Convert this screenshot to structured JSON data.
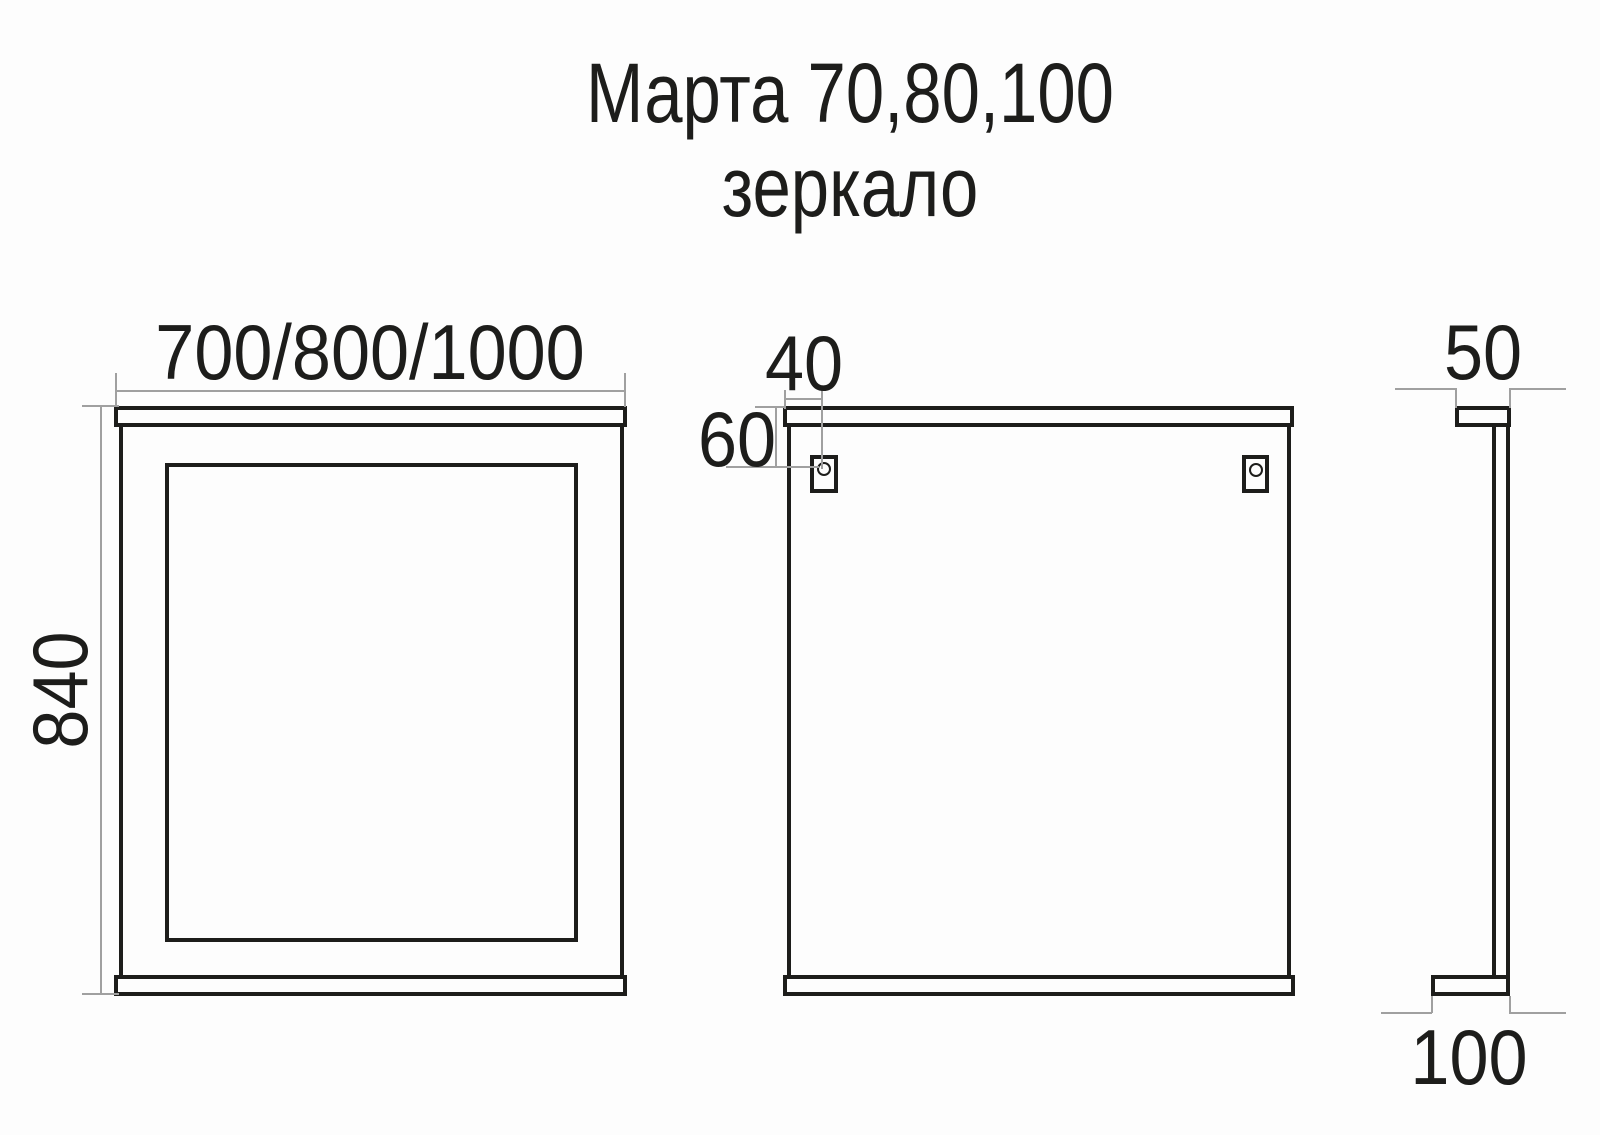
{
  "title": {
    "line1": "Марта 70,80,100",
    "line2": "зеркало"
  },
  "views": {
    "front": {
      "label_width": "700/800/1000",
      "label_height": "840"
    },
    "back": {
      "label_bracket_offset_x": "40",
      "label_bracket_offset_y": "60"
    },
    "side": {
      "label_top_shelf_depth": "50",
      "label_bottom_shelf_depth": "100"
    }
  },
  "colors": {
    "outline": "#1d1d1b",
    "dimension_line": "#a0a0a0",
    "background": "#fdfdfd"
  }
}
